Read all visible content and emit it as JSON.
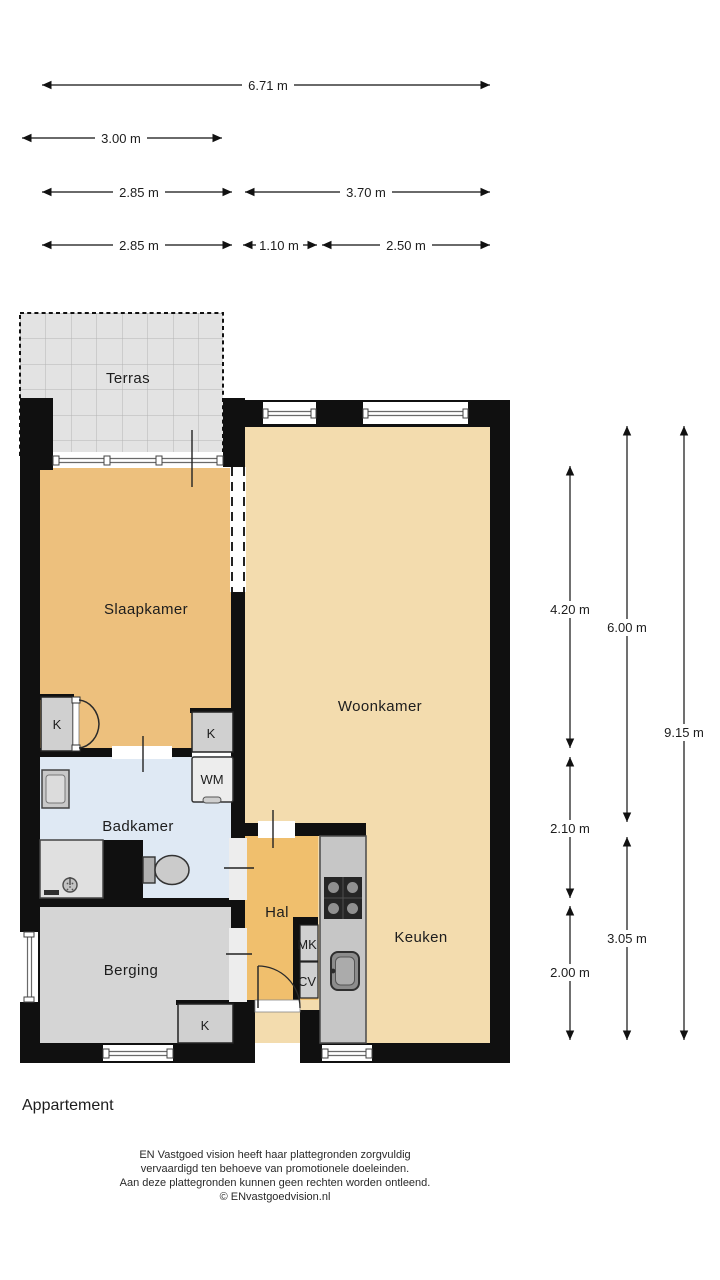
{
  "plan": {
    "title": "Appartement",
    "disclaimer": [
      "EN Vastgoed vision heeft haar plattegronden zorgvuldig",
      "vervaardigd ten behoeve van promotionele doeleinden.",
      "Aan deze plattegronden kunnen geen rechten worden ontleend.",
      "© ENvastgoedvision.nl"
    ]
  },
  "rooms": {
    "terras": "Terras",
    "slaapkamer": "Slaapkamer",
    "woonkamer": "Woonkamer",
    "badkamer": "Badkamer",
    "hal": "Hal",
    "berging": "Berging",
    "keuken": "Keuken"
  },
  "closets": {
    "k1": "K",
    "k2": "K",
    "k3": "K",
    "wm": "WM",
    "mk": "MK",
    "cv": "CV"
  },
  "dimensions": {
    "top": [
      {
        "id": "total-width",
        "label": "6.71 m"
      },
      {
        "id": "terrace-width",
        "label": "3.00 m"
      },
      {
        "id": "bedroom-width",
        "label": "2.85 m"
      },
      {
        "id": "living-width",
        "label": "3.70 m"
      },
      {
        "id": "bedroom-width-2",
        "label": "2.85 m"
      },
      {
        "id": "hall-width",
        "label": "1.10 m"
      },
      {
        "id": "kitchen-width",
        "label": "2.50 m"
      }
    ],
    "right": [
      {
        "id": "bedroom-depth",
        "label": "4.20 m"
      },
      {
        "id": "living-depth",
        "label": "6.00 m"
      },
      {
        "id": "total-depth",
        "label": "9.15 m"
      },
      {
        "id": "bathroom-depth",
        "label": "2.10 m"
      },
      {
        "id": "kitchen-depth",
        "label": "3.05 m"
      },
      {
        "id": "storage-depth",
        "label": "2.00 m"
      }
    ]
  },
  "colors": {
    "wall": "#101010",
    "bedroom_floor": "#edc07d",
    "hall_floor": "#f0bf6d",
    "living_floor": "#f3dcae",
    "bath_floor": "#dfe9f4",
    "storage_floor": "#d5d5d5",
    "terrace_floor": "#e3e3e3",
    "closet_fill": "#d0d0d0",
    "counter_fill": "#c6c6c6"
  }
}
